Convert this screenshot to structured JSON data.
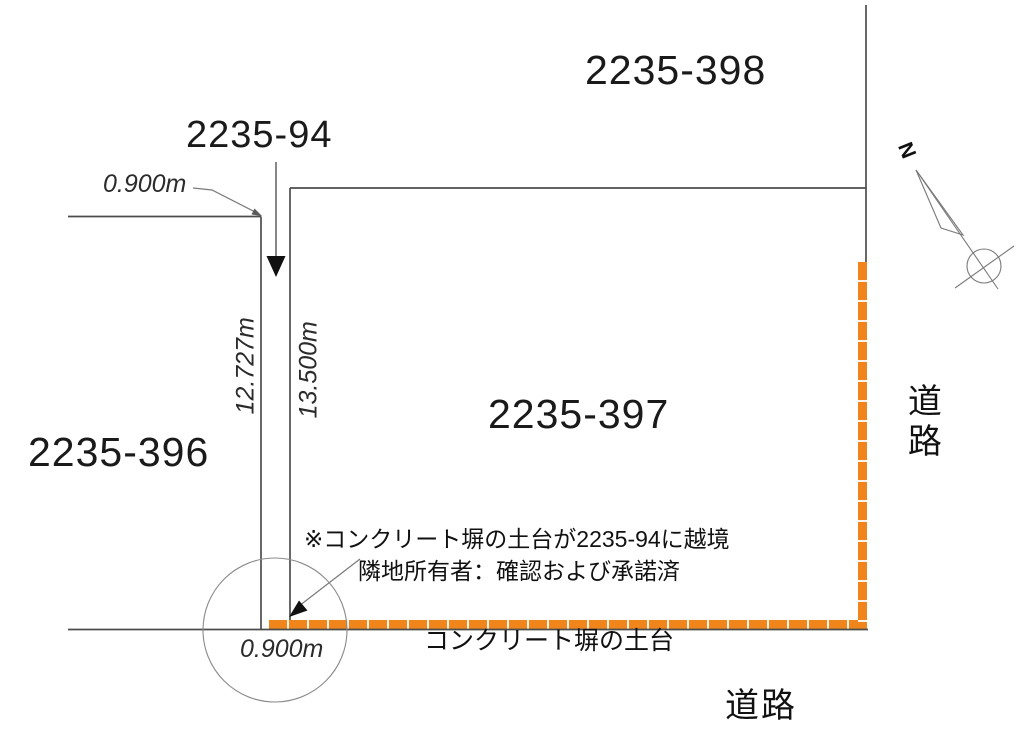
{
  "drawing": {
    "parcels": {
      "p398": "2235-398",
      "p94": "2235-94",
      "p396": "2235-396",
      "p397": "2235-397"
    },
    "measurements": {
      "strip_top_width": "0.900m",
      "strip_west_length": "12.727m",
      "strip_east_length": "13.500m",
      "strip_bottom_width": "0.900m"
    },
    "annotations": {
      "encroachment_note": "※コンクリート塀の土台が2235-94に越境",
      "owner_note": "隣地所有者：確認および承諾済",
      "fence_label": "コンクリート塀の土台"
    },
    "roads": {
      "east": "道路",
      "south": "道路"
    },
    "compass": {
      "north_label": "N"
    }
  },
  "colors": {
    "fence": "#F0861B",
    "line": "#4d4d4d",
    "thin": "#7a7a7a",
    "text": "#1a1a1a"
  }
}
